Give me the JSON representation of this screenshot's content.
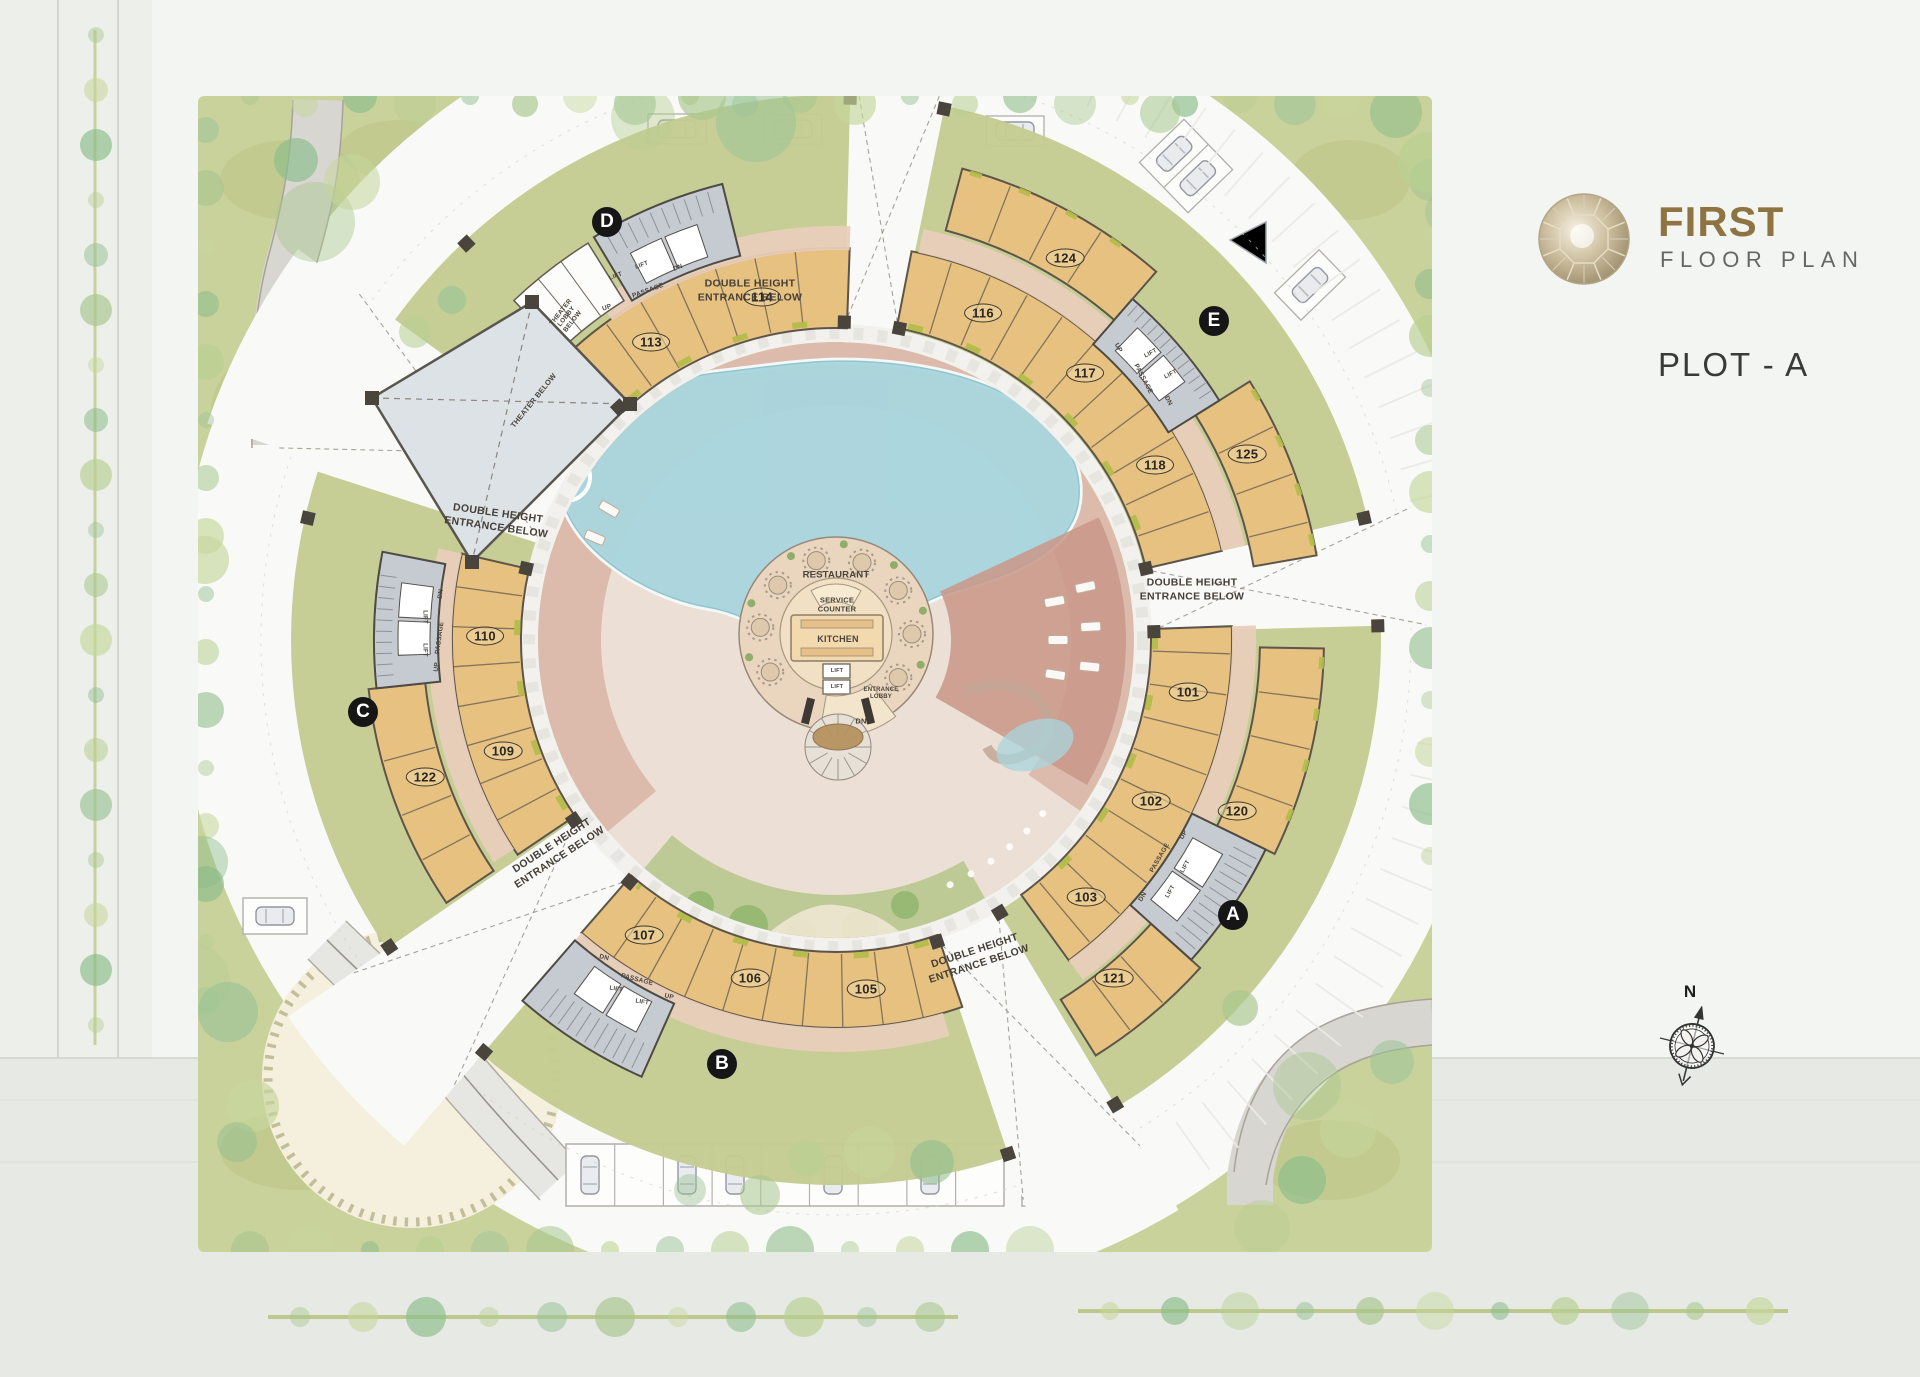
{
  "title_block": {
    "title": "FIRST",
    "subtitle": "FLOOR PLAN",
    "plot_label": "PLOT - A"
  },
  "compass_label": "N",
  "colors": {
    "accent_gold": "#8d7440",
    "text_dark": "#3a3a3a",
    "text_gray": "#666666",
    "building_tan": "#e6c180",
    "building_outline": "#5d554a",
    "passage_pink": "#e9cdb9",
    "core_gray": "#c6cbd1",
    "landscape_green": "#c7cf95",
    "pool_blue": "#a9d5de",
    "deck_pink": "#d9b1a1",
    "terracotta": "#c9998a",
    "theater_gray": "#dce2e6",
    "badge_black": "#161616",
    "plot_white": "#f9faf8"
  },
  "plan": {
    "wing_badges": [
      {
        "label": "D",
        "x": 607,
        "y": 222
      },
      {
        "label": "E",
        "x": 1214,
        "y": 321
      },
      {
        "label": "C",
        "x": 363,
        "y": 712
      },
      {
        "label": "B",
        "x": 722,
        "y": 1064
      },
      {
        "label": "A",
        "x": 1233,
        "y": 915
      }
    ],
    "unit_badges": [
      {
        "number": "113",
        "x": 651,
        "y": 342
      },
      {
        "number": "114",
        "x": 762,
        "y": 297
      },
      {
        "number": "116",
        "x": 983,
        "y": 313
      },
      {
        "number": "124",
        "x": 1065,
        "y": 258
      },
      {
        "number": "117",
        "x": 1085,
        "y": 373
      },
      {
        "number": "118",
        "x": 1155,
        "y": 465
      },
      {
        "number": "125",
        "x": 1247,
        "y": 454
      },
      {
        "number": "110",
        "x": 485,
        "y": 636
      },
      {
        "number": "109",
        "x": 503,
        "y": 751
      },
      {
        "number": "122",
        "x": 425,
        "y": 777
      },
      {
        "number": "107",
        "x": 644,
        "y": 935
      },
      {
        "number": "106",
        "x": 750,
        "y": 978
      },
      {
        "number": "105",
        "x": 866,
        "y": 989
      },
      {
        "number": "101",
        "x": 1188,
        "y": 692
      },
      {
        "number": "102",
        "x": 1151,
        "y": 801
      },
      {
        "number": "103",
        "x": 1086,
        "y": 897
      },
      {
        "number": "120",
        "x": 1237,
        "y": 811
      },
      {
        "number": "121",
        "x": 1114,
        "y": 978
      }
    ],
    "entrance_notes": [
      {
        "text": "DOUBLE HEIGHT\nENTRANCE BELOW",
        "x": 750,
        "y": 291,
        "r": 0
      },
      {
        "text": "DOUBLE HEIGHT\nENTRANCE BELOW",
        "x": 1192,
        "y": 590,
        "r": 0
      },
      {
        "text": "DOUBLE HEIGHT\nENTRANCE BELOW",
        "x": 497,
        "y": 521,
        "r": 8
      },
      {
        "text": "DOUBLE HEIGHT\nENTRANCE BELOW",
        "x": 556,
        "y": 852,
        "r": -33
      },
      {
        "text": "DOUBLE HEIGHT\nENTRANCE BELOW",
        "x": 977,
        "y": 958,
        "r": -18
      }
    ],
    "annotations": [
      {
        "text": "RESTAURANT",
        "x": 836,
        "y": 576,
        "r": 0,
        "s": 9.5
      },
      {
        "text": "SERVICE\nCOUNTER",
        "x": 837,
        "y": 605,
        "r": 0,
        "s": 7.5
      },
      {
        "text": "KITCHEN",
        "x": 838,
        "y": 639,
        "r": 0,
        "s": 9
      },
      {
        "text": "LIFT",
        "x": 837,
        "y": 671,
        "r": 0,
        "s": 5.5
      },
      {
        "text": "LIFT",
        "x": 837,
        "y": 687,
        "r": 0,
        "s": 5.5
      },
      {
        "text": "ENTRANCE\nLOBBY",
        "x": 881,
        "y": 694,
        "r": 0,
        "s": 6
      },
      {
        "text": "DN",
        "x": 861,
        "y": 722,
        "r": 0,
        "s": 7.5
      },
      {
        "text": "LIFT",
        "x": 616,
        "y": 277,
        "r": -20,
        "s": 6
      },
      {
        "text": "LIFT",
        "x": 642,
        "y": 266,
        "r": -20,
        "s": 6
      },
      {
        "text": "PASSAGE",
        "x": 648,
        "y": 291,
        "r": -20,
        "s": 6.5
      },
      {
        "text": "UP",
        "x": 607,
        "y": 308,
        "r": -20,
        "s": 6.5
      },
      {
        "text": "DN",
        "x": 678,
        "y": 268,
        "r": -20,
        "s": 6.5
      },
      {
        "text": "THEATER\nLOBBY\nBELOW",
        "x": 567,
        "y": 317,
        "r": -52,
        "s": 6.5
      },
      {
        "text": "THEATER BELOW",
        "x": 534,
        "y": 401,
        "r": -51,
        "s": 7.5
      },
      {
        "text": "UP",
        "x": 1118,
        "y": 348,
        "r": 62,
        "s": 6.5
      },
      {
        "text": "LIFT",
        "x": 1151,
        "y": 354,
        "r": -28,
        "s": 6
      },
      {
        "text": "LIFT",
        "x": 1171,
        "y": 375,
        "r": -28,
        "s": 6
      },
      {
        "text": "PASSAGE",
        "x": 1143,
        "y": 379,
        "r": 62,
        "s": 6.5
      },
      {
        "text": "DN",
        "x": 1168,
        "y": 401,
        "r": 62,
        "s": 6.5
      },
      {
        "text": "DN",
        "x": 441,
        "y": 594,
        "r": -82,
        "s": 6.5
      },
      {
        "text": "PASSAGE",
        "x": 440,
        "y": 638,
        "r": -82,
        "s": 6.5
      },
      {
        "text": "UP",
        "x": 437,
        "y": 667,
        "r": -82,
        "s": 6.5
      },
      {
        "text": "LIFT",
        "x": 424,
        "y": 617,
        "r": 90,
        "s": 6
      },
      {
        "text": "LIFT",
        "x": 424,
        "y": 650,
        "r": 90,
        "s": 6
      },
      {
        "text": "DN",
        "x": 604,
        "y": 958,
        "r": 14,
        "s": 6.5
      },
      {
        "text": "PASSAGE",
        "x": 637,
        "y": 980,
        "r": 14,
        "s": 6.5
      },
      {
        "text": "UP",
        "x": 669,
        "y": 997,
        "r": 14,
        "s": 6.5
      },
      {
        "text": "LIFT",
        "x": 616,
        "y": 990,
        "r": 10,
        "s": 6
      },
      {
        "text": "LIFT",
        "x": 642,
        "y": 1003,
        "r": 10,
        "s": 6
      },
      {
        "text": "UP",
        "x": 1184,
        "y": 835,
        "r": -60,
        "s": 6.5
      },
      {
        "text": "PASSAGE",
        "x": 1160,
        "y": 858,
        "r": -60,
        "s": 6.5
      },
      {
        "text": "LIFT",
        "x": 1186,
        "y": 867,
        "r": -60,
        "s": 6
      },
      {
        "text": "LIFT",
        "x": 1171,
        "y": 892,
        "r": -60,
        "s": 6
      },
      {
        "text": "DN",
        "x": 1143,
        "y": 897,
        "r": -60,
        "s": 6.5
      }
    ]
  }
}
